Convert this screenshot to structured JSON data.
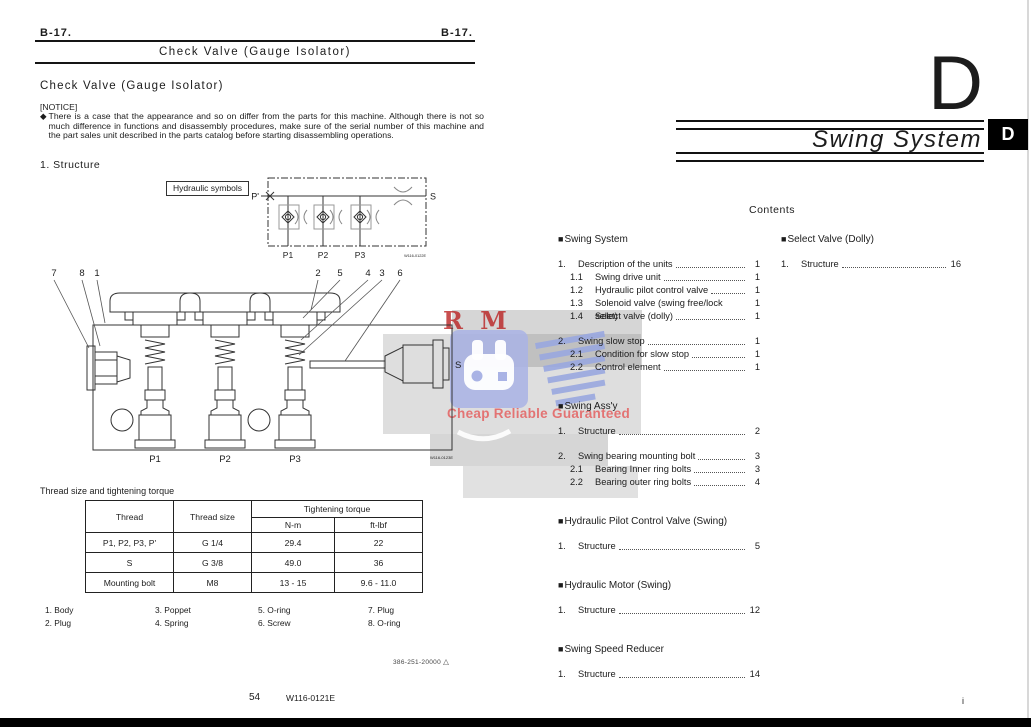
{
  "page_left": {
    "header_left": "B-17.",
    "header_right": "B-17.",
    "title_bar": "Check Valve (Gauge Isolator)",
    "section_title": "Check Valve (Gauge Isolator)",
    "notice_label": "[NOTICE]",
    "notice_bullet": "◆",
    "notice_text": "There is a case that the appearance and so on differ from the parts for this machine. Although there is not so much difference in functions and disassembly procedures, make sure of the serial number of this machine and the part sales unit described in the parts catalog before starting disassembling operations.",
    "structure_heading": "1.  Structure",
    "hydraulic_symbols_label": "Hydraulic symbols",
    "schematic": {
      "port_p": "P'",
      "port_s": "S",
      "port_p1": "P1",
      "port_p2": "P2",
      "port_p3": "P3",
      "figure_number": "W116-0122E"
    },
    "diagram": {
      "callouts_left": [
        "7",
        "8",
        "1"
      ],
      "callouts_right": [
        "2",
        "5",
        "4",
        "3",
        "6"
      ],
      "port_p1": "P1",
      "port_p2": "P2",
      "port_p3": "P3",
      "port_s": "S",
      "figure_number": "W116-0123E"
    },
    "table_caption": "Thread size and tightening torque",
    "table": {
      "col_thread": "Thread",
      "col_thread_size": "Thread size",
      "col_torque": "Tightening torque",
      "col_nm": "N-m",
      "col_ftlbf": "ft-lbf",
      "rows": [
        [
          "P1, P2, P3, P'",
          "G 1/4",
          "29.4",
          "22"
        ],
        [
          "S",
          "G 3/8",
          "49.0",
          "36"
        ],
        [
          "Mounting bolt",
          "M8",
          "13 - 15",
          "9.6 - 11.0"
        ]
      ]
    },
    "legend": [
      [
        "1. Body",
        "2. Plug"
      ],
      [
        "3. Poppet",
        "4. Spring"
      ],
      [
        "5. O-ring",
        "6. Screw"
      ],
      [
        "7. Plug",
        "8. O-ring"
      ]
    ],
    "doc_number": "386-251-20000",
    "doc_number_mark": "△",
    "page_number": "54",
    "manual_code": "W116-0121E"
  },
  "page_right": {
    "chapter_letter": "D",
    "chapter_title": "Swing System",
    "tab_letter": "D",
    "contents_title": "Contents",
    "toc_left": [
      {
        "title": "Swing System",
        "items": [
          {
            "num": "1.",
            "label": "Description of the units",
            "page": "1",
            "sub": false
          },
          {
            "num": "1.1",
            "label": "Swing drive unit",
            "page": "1",
            "sub": true
          },
          {
            "num": "1.2",
            "label": "Hydraulic pilot control valve",
            "page": "1",
            "sub": true
          },
          {
            "num": "1.3",
            "label": "Solenoid valve (swing free/lock selet)",
            "page": "1",
            "sub": true
          },
          {
            "num": "1.4",
            "label": "Select valve (dolly)",
            "page": "1",
            "sub": true
          },
          {
            "num": "2.",
            "label": "Swing slow stop",
            "page": "1",
            "sub": false,
            "gap": true
          },
          {
            "num": "2.1",
            "label": "Condition for slow stop",
            "page": "1",
            "sub": true
          },
          {
            "num": "2.2",
            "label": "Control element",
            "page": "1",
            "sub": true
          }
        ]
      },
      {
        "title": "Swing Ass'y",
        "items": [
          {
            "num": "1.",
            "label": "Structure",
            "page": "2",
            "sub": false
          },
          {
            "num": "2.",
            "label": "Swing bearing mounting bolt",
            "page": "3",
            "sub": false,
            "gap": true
          },
          {
            "num": "2.1",
            "label": "Bearing Inner ring bolts",
            "page": "3",
            "sub": true
          },
          {
            "num": "2.2",
            "label": "Bearing outer ring bolts",
            "page": "4",
            "sub": true
          }
        ]
      },
      {
        "title": "Hydraulic Pilot Control Valve (Swing)",
        "items": [
          {
            "num": "1.",
            "label": "Structure",
            "page": "5",
            "sub": false
          }
        ]
      },
      {
        "title": "Hydraulic Motor (Swing)",
        "items": [
          {
            "num": "1.",
            "label": "Structure",
            "page": "12",
            "sub": false
          }
        ]
      },
      {
        "title": "Swing Speed Reducer",
        "items": [
          {
            "num": "1.",
            "label": "Structure",
            "page": "14",
            "sub": false
          }
        ]
      }
    ],
    "toc_right": [
      {
        "title": "Select Valve (Dolly)",
        "items": [
          {
            "num": "1.",
            "label": "Structure",
            "page": "16",
            "sub": false
          }
        ]
      }
    ],
    "page_number": "i"
  },
  "watermark": {
    "letters": "R M",
    "tagline": "Cheap Reliable Guaranteed",
    "red": "#b91e1e",
    "blue": "#a9b3e5"
  }
}
